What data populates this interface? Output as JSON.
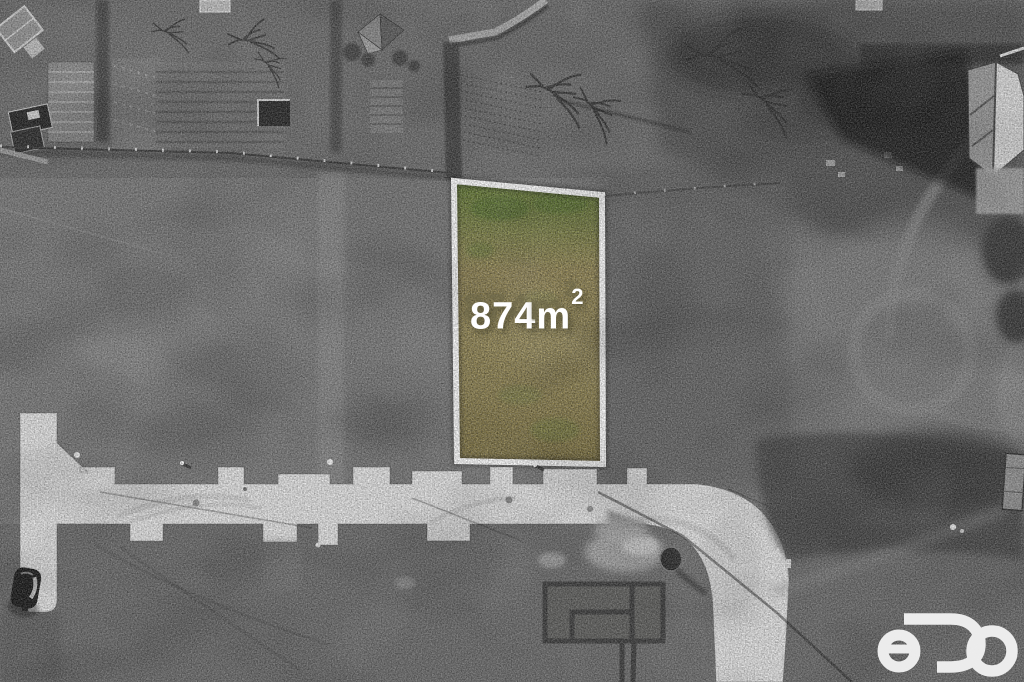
{
  "colors": {
    "plot_border": "#ffffff",
    "grass_green": "#74903e",
    "grass_tan": "#b3a468",
    "grass_dark": "#97894f",
    "label_text": "#ffffff",
    "logo": "#f2f2f2",
    "road": "#e7e7e7"
  },
  "plot_label": {
    "value": "874",
    "unit": "m",
    "exponent": "2"
  },
  "logo": {
    "text": "eDO"
  }
}
